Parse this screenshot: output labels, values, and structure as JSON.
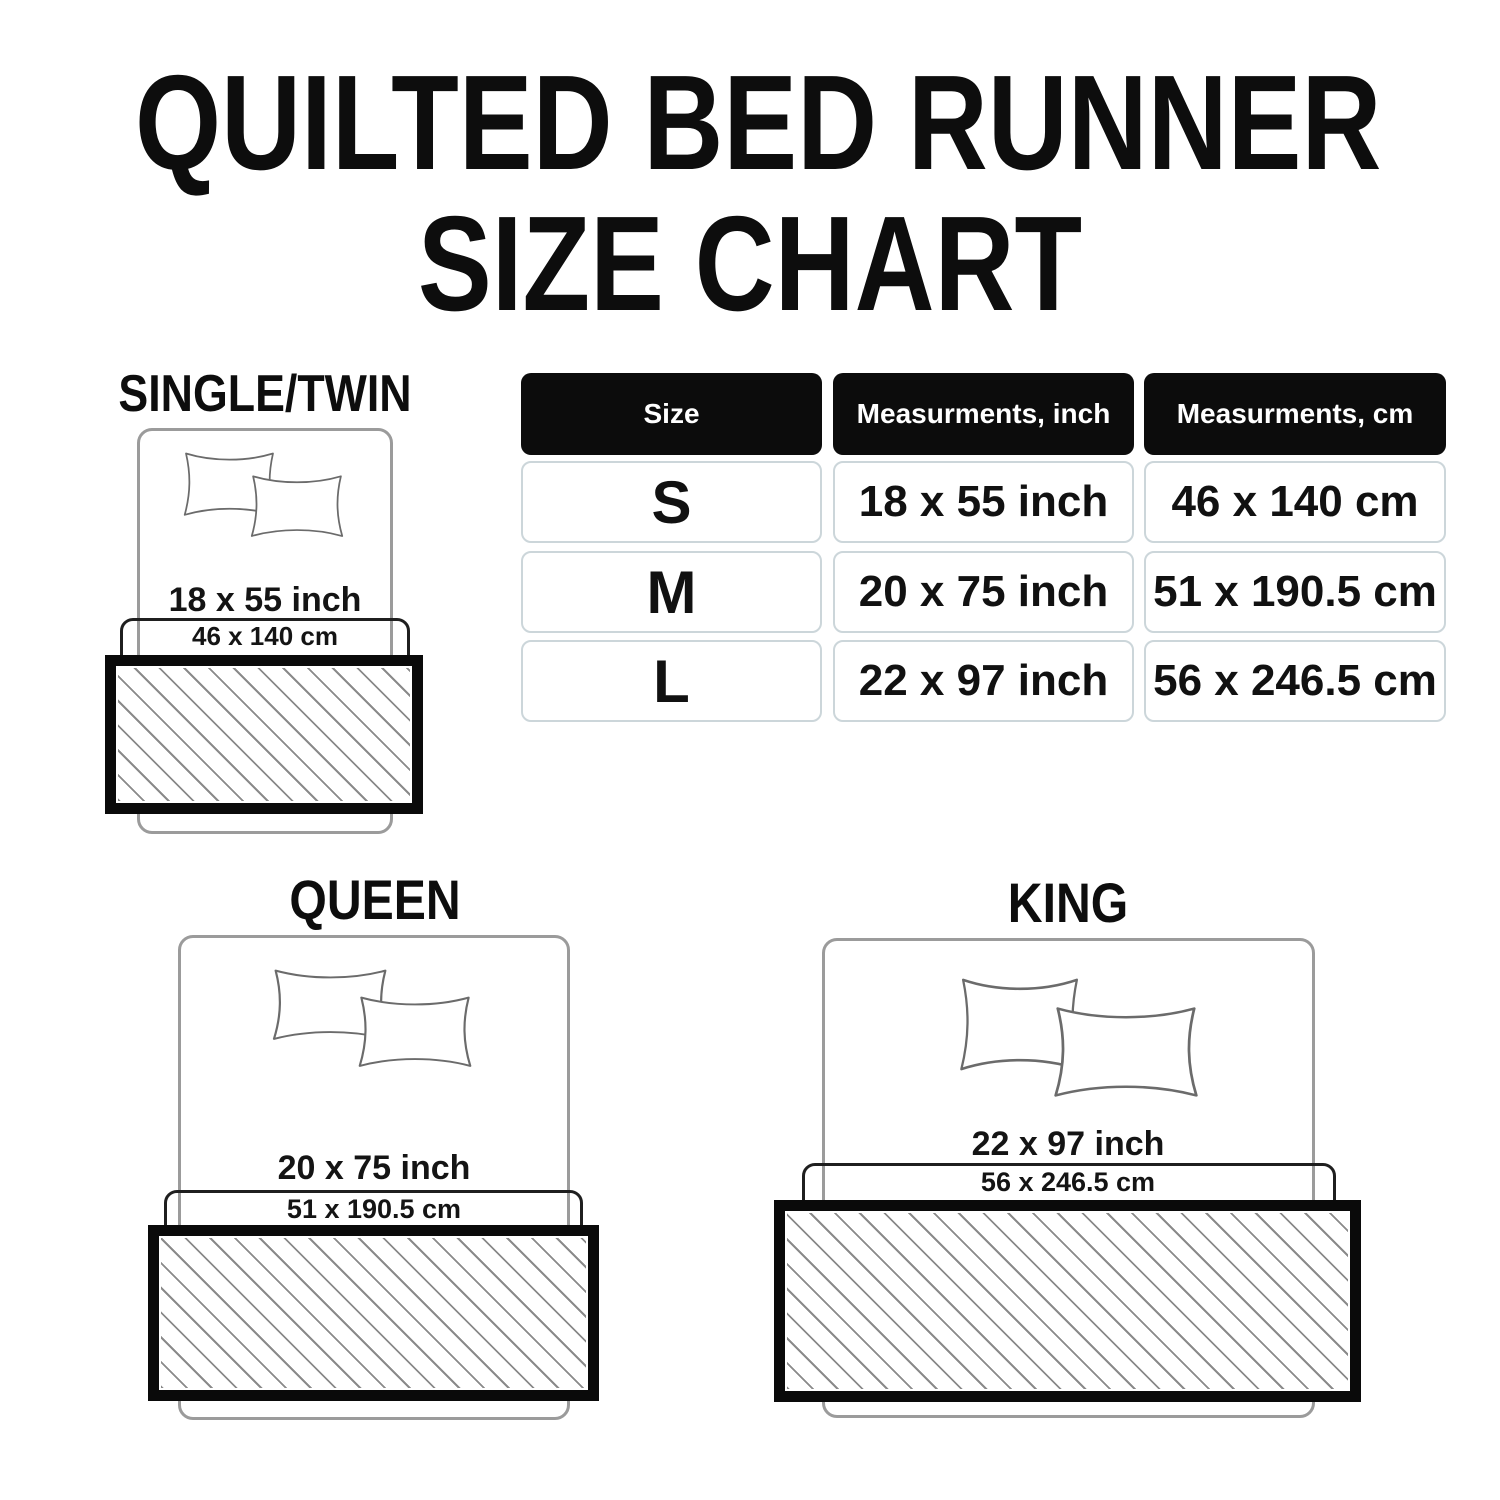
{
  "title": {
    "line1": "QUILTED BED RUNNER",
    "line2": "SIZE CHART"
  },
  "table": {
    "headers": {
      "size": "Size",
      "inch": "Measurments, inch",
      "cm": "Measurments, cm"
    },
    "rows": [
      {
        "size": "S",
        "inch": "18 x 55 inch",
        "cm": "46 x 140 cm"
      },
      {
        "size": "M",
        "inch": "20 x 75 inch",
        "cm": "51 x 190.5 cm"
      },
      {
        "size": "L",
        "inch": "22 x 97 inch",
        "cm": "56 x 246.5 cm"
      }
    ]
  },
  "diagrams": [
    {
      "label": "SINGLE/TWIN",
      "inch": "18 x 55 inch",
      "cm": "46 x 140 cm"
    },
    {
      "label": "QUEEN",
      "inch": "20 x 75 inch",
      "cm": "51 x 190.5 cm"
    },
    {
      "label": "KING",
      "inch": "22 x 97 inch",
      "cm": "56 x 246.5 cm"
    }
  ],
  "colors": {
    "text": "#0d0d0d",
    "table_header_bg": "#0c0c0c",
    "table_header_text": "#ffffff",
    "table_cell_border": "#ccd6da",
    "bed_outline": "#9b9b9b",
    "pillow_outline": "#6b6b6b",
    "cm_box_outline": "#1f1f1f",
    "runner_border": "#0a0a0a",
    "hatch_line": "#8a8a8a"
  }
}
